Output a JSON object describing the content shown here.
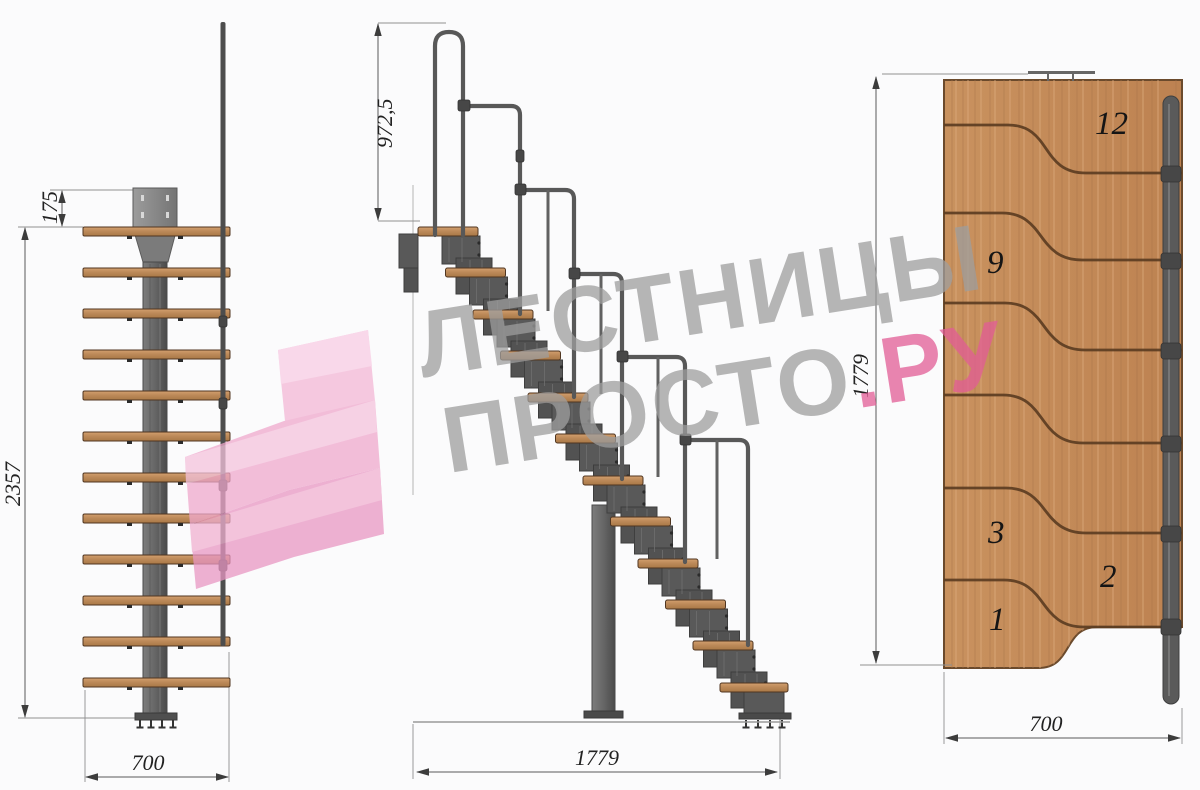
{
  "drawing": {
    "watermark": {
      "line1": "ЛЕСТНИЦЫ",
      "line2_grey": "ПРОСТО",
      "line2_pink": ".РУ"
    },
    "front_view": {
      "dim_plate": "175",
      "dim_height": "2357",
      "dim_width": "700"
    },
    "side_view": {
      "dim_handrail": "972,5",
      "dim_run": "1779"
    },
    "plan_view": {
      "dim_run": "1779",
      "dim_width": "700",
      "step_labels": [
        "12",
        "9",
        "3",
        "2",
        "1"
      ]
    },
    "colors": {
      "wood": "#c68f60",
      "metal": "#585858",
      "watermark_grey": "#9e9e9e",
      "watermark_pink": "#e25d96",
      "logo_pink": "#efa8cd"
    }
  }
}
